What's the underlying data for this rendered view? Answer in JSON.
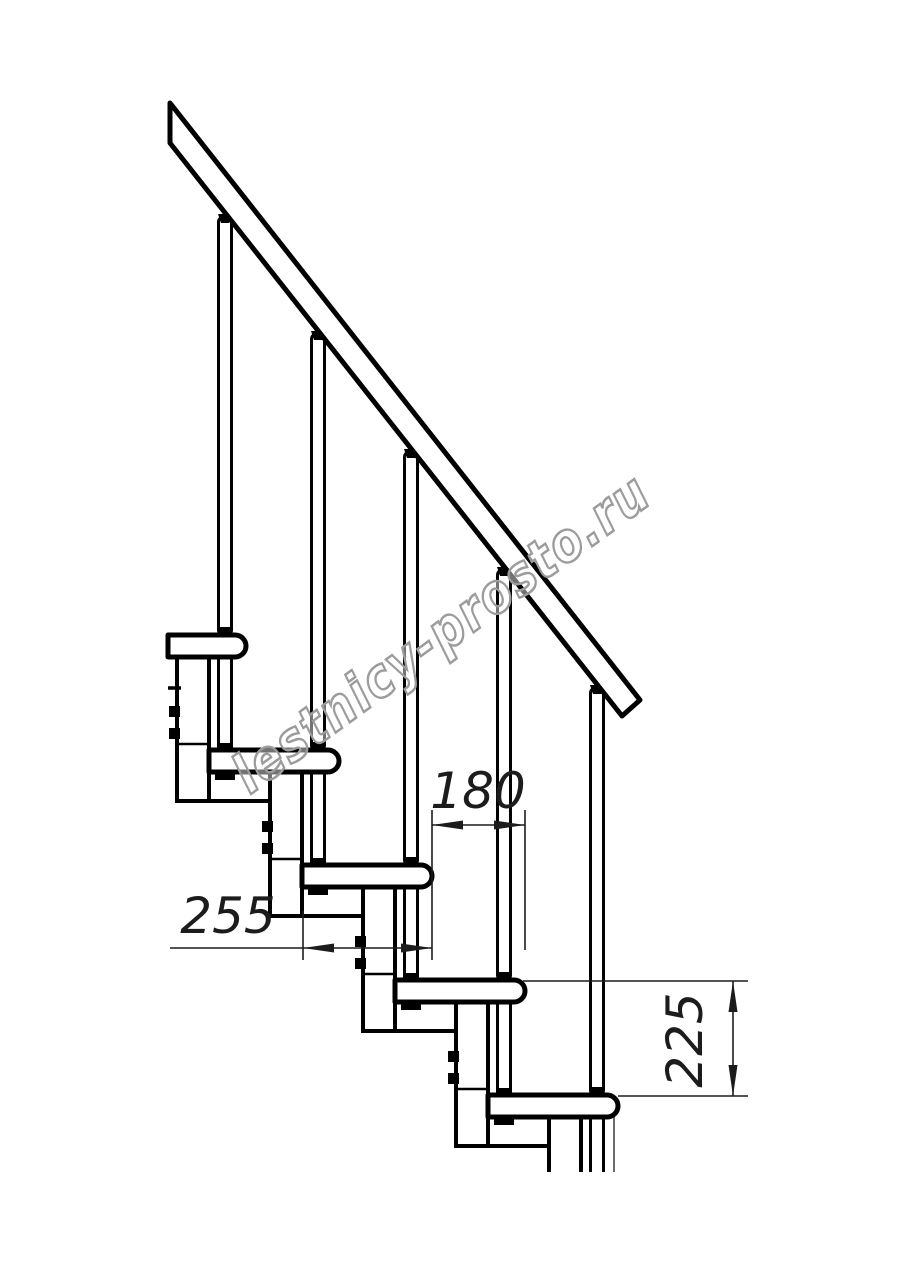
{
  "drawing": {
    "title": "modular-staircase-side-elevation",
    "background": "#ffffff",
    "line_color": "#000000",
    "dimension_color": "#1c1c1c",
    "treads_count": "5",
    "balusters_count": "5",
    "dimensions": {
      "run": {
        "value": "180"
      },
      "tread_depth": {
        "value": "255"
      },
      "rise": {
        "value": "225"
      }
    },
    "watermark": {
      "text": "lestnicy-prosto.ru",
      "stroke": "#9c9c9c",
      "fill": "rgba(255,255,255,0.45)"
    }
  }
}
